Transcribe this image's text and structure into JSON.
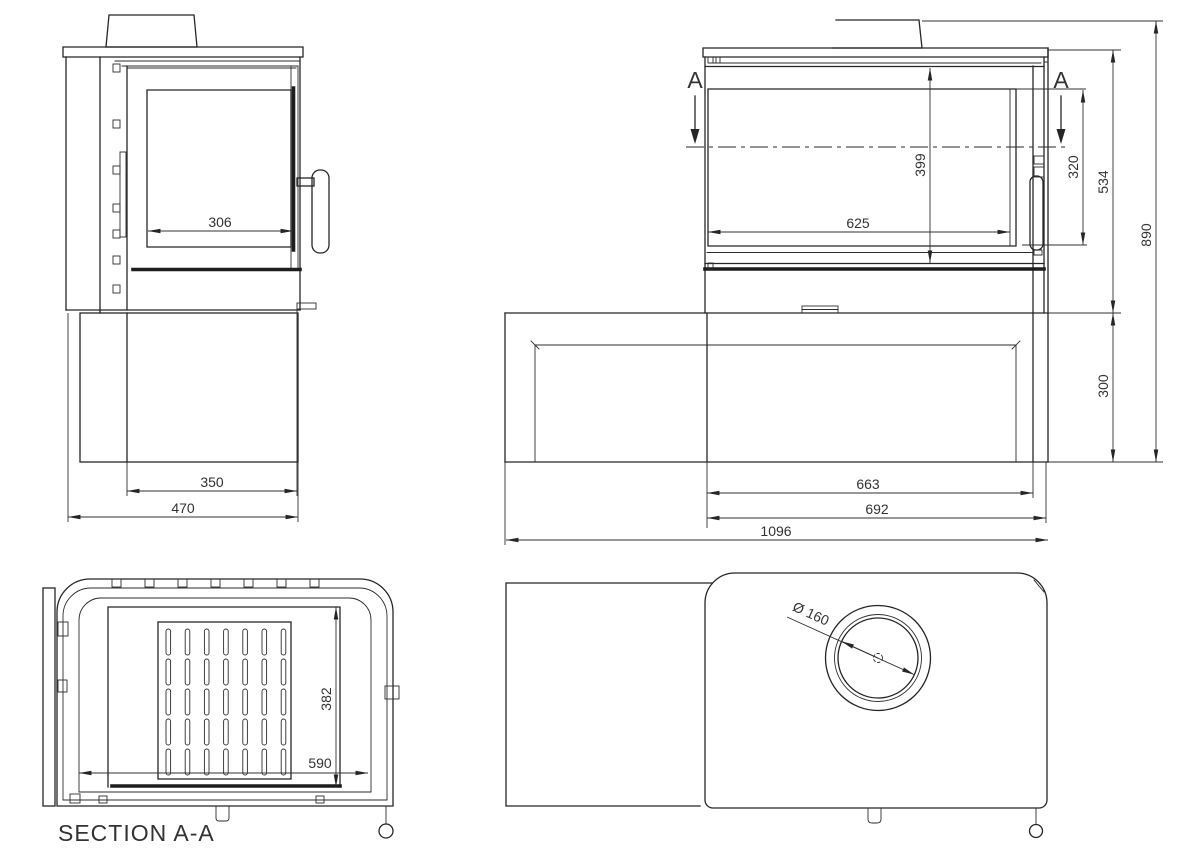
{
  "labels": {
    "section_title": "SECTION A-A",
    "marker_left": "A",
    "marker_right": "A"
  },
  "dims": {
    "side_glass_depth": "306",
    "side_plinth_depth": "350",
    "side_overall_depth": "470",
    "front_glass_height": "399",
    "front_door_height": "320",
    "front_glass_width": "625",
    "front_stove_height": "534",
    "front_overall_height": "890",
    "front_plinth_height": "300",
    "front_firebox_width": "663",
    "front_stove_width": "692",
    "front_overall_width": "1096",
    "section_depth": "382",
    "section_width": "590",
    "flue_diameter": "Ø 160"
  },
  "colors": {
    "line": "#262626",
    "text": "#333333",
    "background": "#ffffff"
  }
}
